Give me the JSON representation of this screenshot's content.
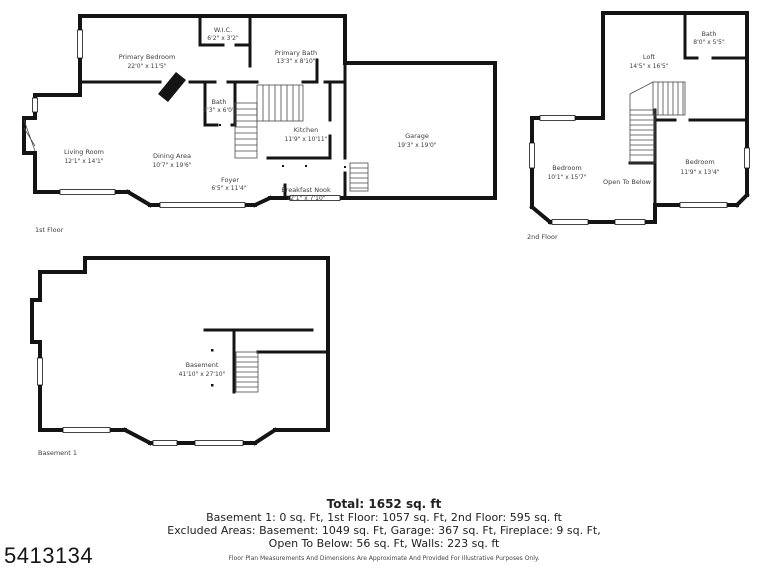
{
  "watermark": "5413134",
  "first_floor": {
    "label": "1st Floor",
    "rooms": [
      {
        "name": "Primary Bedroom",
        "dims": "22'0\" x 11'5\""
      },
      {
        "name": "W.I.C.",
        "dims": "6'2\" x 3'2\""
      },
      {
        "name": "Primary Bath",
        "dims": "13'3\" x 8'10\""
      },
      {
        "name": "Bath",
        "dims": "3'3\" x 6'0\""
      },
      {
        "name": "Kitchen",
        "dims": "11'9\" x 10'11\""
      },
      {
        "name": "Living Room",
        "dims": "12'1\" x 14'1\""
      },
      {
        "name": "Dining Area",
        "dims": "10'7\" x 19'6\""
      },
      {
        "name": "Foyer",
        "dims": "6'5\" x 11'4\""
      },
      {
        "name": "Breakfast Nook",
        "dims": "12'1\" x 7'10\""
      },
      {
        "name": "Garage",
        "dims": "19'3\" x 19'0\""
      }
    ]
  },
  "second_floor": {
    "label": "2nd Floor",
    "rooms": [
      {
        "name": "Loft",
        "dims": "14'5\" x 16'5\""
      },
      {
        "name": "Bath",
        "dims": "8'0\" x 5'5\""
      },
      {
        "name": "Bedroom",
        "dims": "10'1\" x 15'7\""
      },
      {
        "name": "Open To Below",
        "dims": ""
      },
      {
        "name": "Bedroom",
        "dims": "11'9\" x 13'4\""
      }
    ]
  },
  "basement": {
    "label": "Basement 1",
    "rooms": [
      {
        "name": "Basement",
        "dims": "41'10\" x 27'10\""
      }
    ]
  },
  "summary": {
    "total": "Total: 1652 sq. ft",
    "line1": "Basement 1: 0 sq. Ft, 1st Floor: 1057 sq. Ft, 2nd Floor: 595 sq. ft",
    "line2": "Excluded Areas: Basement: 1049 sq. Ft, Garage: 367 sq. Ft, Fireplace: 9 sq. Ft,",
    "line3": "Open To Below: 56 sq. Ft, Walls: 223 sq. ft",
    "disclaimer": "Floor Plan Measurements And Dimensions Are Approximate And Provided For Illustrative Purposes Only."
  }
}
